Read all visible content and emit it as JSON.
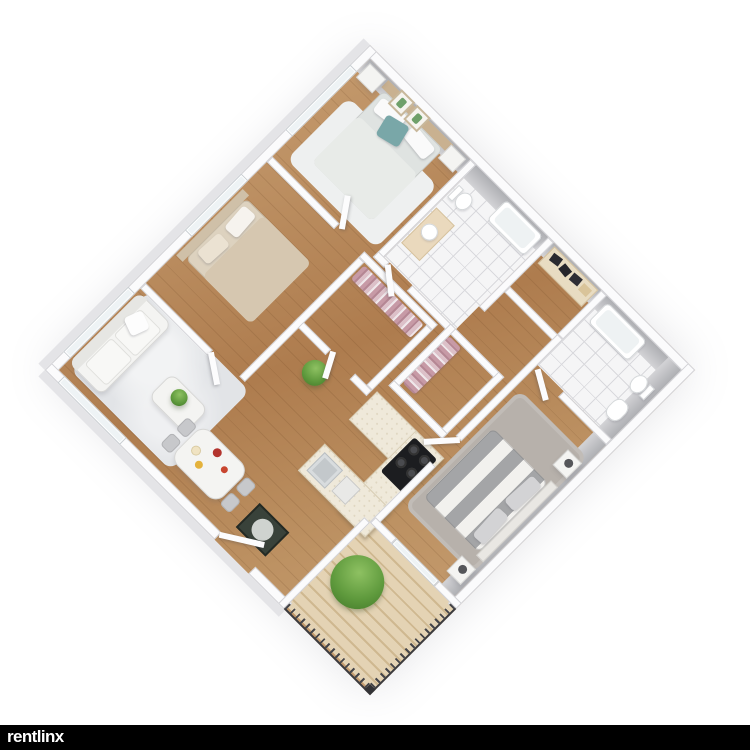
{
  "watermark": {
    "text": "rentlinx",
    "bar_color": "#000000",
    "text_color": "#ffffff"
  },
  "scene": {
    "type": "3d-floorplan-render",
    "view": "isometric top-down, plan rotated 45 degrees on white background",
    "unit_summary": "3 bedroom / 2 bathroom apartment with balcony",
    "bedrooms": 3,
    "bathrooms": 2,
    "walk_in_closets": 2,
    "balcony": true
  },
  "rooms": [
    {
      "id": "bedroom-1",
      "name": "Bedroom (top)",
      "floor": "hardwood with white rug"
    },
    {
      "id": "bathroom-1",
      "name": "Bathroom 1",
      "floor": "white tile"
    },
    {
      "id": "shelf-closet",
      "name": "Storage closet with shelves",
      "floor": "hardwood"
    },
    {
      "id": "bathroom-2",
      "name": "Bathroom 2",
      "floor": "white tile"
    },
    {
      "id": "walk-in-closet-a",
      "name": "Walk-in closet A",
      "floor": "hardwood"
    },
    {
      "id": "walk-in-closet-b",
      "name": "Walk-in closet B",
      "floor": "hardwood"
    },
    {
      "id": "bedroom-2",
      "name": "Bedroom (left)",
      "floor": "hardwood"
    },
    {
      "id": "living-room",
      "name": "Living room",
      "floor": "hardwood with gray-white rug"
    },
    {
      "id": "dining-area",
      "name": "Dining area",
      "floor": "hardwood"
    },
    {
      "id": "kitchen",
      "name": "Kitchen (U-shaped)",
      "floor": "hardwood"
    },
    {
      "id": "entry",
      "name": "Entry hall",
      "floor": "hardwood with dark doormat"
    },
    {
      "id": "bedroom-3",
      "name": "Master bedroom",
      "floor": "hardwood with gray shag rug"
    },
    {
      "id": "balcony",
      "name": "Balcony",
      "floor": "wood deck planks with metal railing"
    }
  ],
  "furniture": {
    "bedroom_1": [
      "double bed with teal pillow",
      "two nightstands",
      "two framed cactus prints",
      "window"
    ],
    "bathroom_1": [
      "toilet",
      "vanity with sink",
      "bathtub"
    ],
    "shelf_closet": [
      "shelving with dark shoes/boxes"
    ],
    "bathroom_2": [
      "bathtub",
      "toilet",
      "wash basin"
    ],
    "walk_in_closet_a": [
      "hanging clothes rack (pink/mauve)"
    ],
    "walk_in_closet_b": [
      "hanging clothes rack (pink/mauve)"
    ],
    "bedroom_2": [
      "double bed with beige duvet",
      "window"
    ],
    "living_room": [
      "white sofa",
      "coffee table with plant",
      "area rug",
      "two windows",
      "floor plant"
    ],
    "dining_area": [
      "white dining table with food and flowers",
      "four gray chairs"
    ],
    "kitchen": [
      "U-shaped counter",
      "gas stove with 4 burners",
      "sink",
      "second basin"
    ],
    "entry": [
      "dark green doormat",
      "front door"
    ],
    "bedroom_3": [
      "king bed with gray/white striped cover",
      "two nightstands with lamps",
      "gray rug"
    ],
    "balcony": [
      "green shrub plant",
      "sliding glass door",
      "railing"
    ]
  },
  "colors": {
    "background": "#ffffff",
    "wood_floor": "#b5855c",
    "wall_top": "#fbfbfc",
    "wall_face_gray": "#b3b4b7",
    "tile": "#f5f5f6",
    "rug_living": "#e4e6e8",
    "rug_master": "#b7b1ab",
    "deck": "#ddcba8",
    "railing": "#3a3a3e",
    "plant_green": "#5f9a3d",
    "accent_teal_pillow": "#79a7a8",
    "clothes_pink": "#c49aa8",
    "stove_black": "#1c1d20",
    "bed2_beige": "#d6c7b0",
    "doormat": "#39423a"
  }
}
